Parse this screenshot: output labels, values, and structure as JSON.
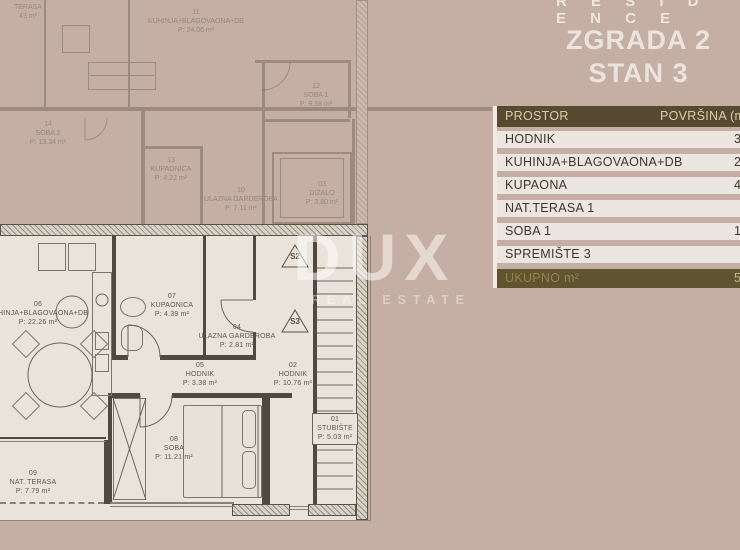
{
  "branding": {
    "residence_text": "R E S I D E N C E",
    "watermark": {
      "name": "DUX",
      "subtitle": "REAL ESTATE"
    }
  },
  "title": {
    "line1": "ZGRADA 2",
    "line2": "STAN 3"
  },
  "table": {
    "header": {
      "prostor": "PROSTOR",
      "povrsina": "POVRŠINA (m²)"
    },
    "rows": [
      {
        "label": "HODNIK",
        "value": "3"
      },
      {
        "label": "KUHINJA+BLAGOVAONA+DB",
        "value": "22"
      },
      {
        "label": "KUPAONA",
        "value": "4"
      },
      {
        "label": "NAT.TERASA 1",
        "value": ""
      },
      {
        "label": "SOBA 1",
        "value": "1"
      },
      {
        "label": "SPREMIŠTE 3",
        "value": ""
      }
    ],
    "total": {
      "label": "UKUPNO m²",
      "value": "5"
    }
  },
  "plan": {
    "main_rooms": {
      "kuhinja06": "06\nKUHINJA+BLAGOVAONA+DB\nP: 22.26 m²",
      "kupaonica07": "07\nKUPAONICA\nP: 4.39 m²",
      "garderoba04": "04\nULAZNA GARDEROBA\nP: 2.81 m²",
      "hodnik05": "05\nHODNIK\nP: 3.38 m²",
      "hodnik02": "02\nHODNIK\nP: 10.76 m²",
      "stubiste01": "01\nSTUBIŠTE\nP: 5.03 m²",
      "soba08": "08\nSOBA\nP: 11.21 m²",
      "terasa09": "09\nNAT. TERASA\nP: 7.79 m²",
      "marker_s2": "S2",
      "marker_s3": "S3"
    },
    "adjacent_rooms": {
      "terasa": "TERASA\n43 m²",
      "kuhinja11": "11\nKUHINJA+BLAGOVAONA+DB\nP: 24.06 m²",
      "soba2_14": "14\nSOBA 2\nP: 13.34 m²",
      "kupaonica13": "13\nKUPAONICA\nP: 4.22 m²",
      "garderoba10": "10\nULAZNA GARDEROBA\nP: 7.11 m²",
      "soba1_12": "12\nSOBA 1\nP: 9.38 m²",
      "dizalo03": "03\nDIZALO\nP: 3.80 m²"
    }
  },
  "colors": {
    "background": "#c5aea3",
    "table_header_bg": "#574a31",
    "table_row_bg": "#ece6e0",
    "table_total_bg": "#5f5330",
    "plan_paper": "#e9e3dc",
    "plan_wall": "#50493f"
  }
}
